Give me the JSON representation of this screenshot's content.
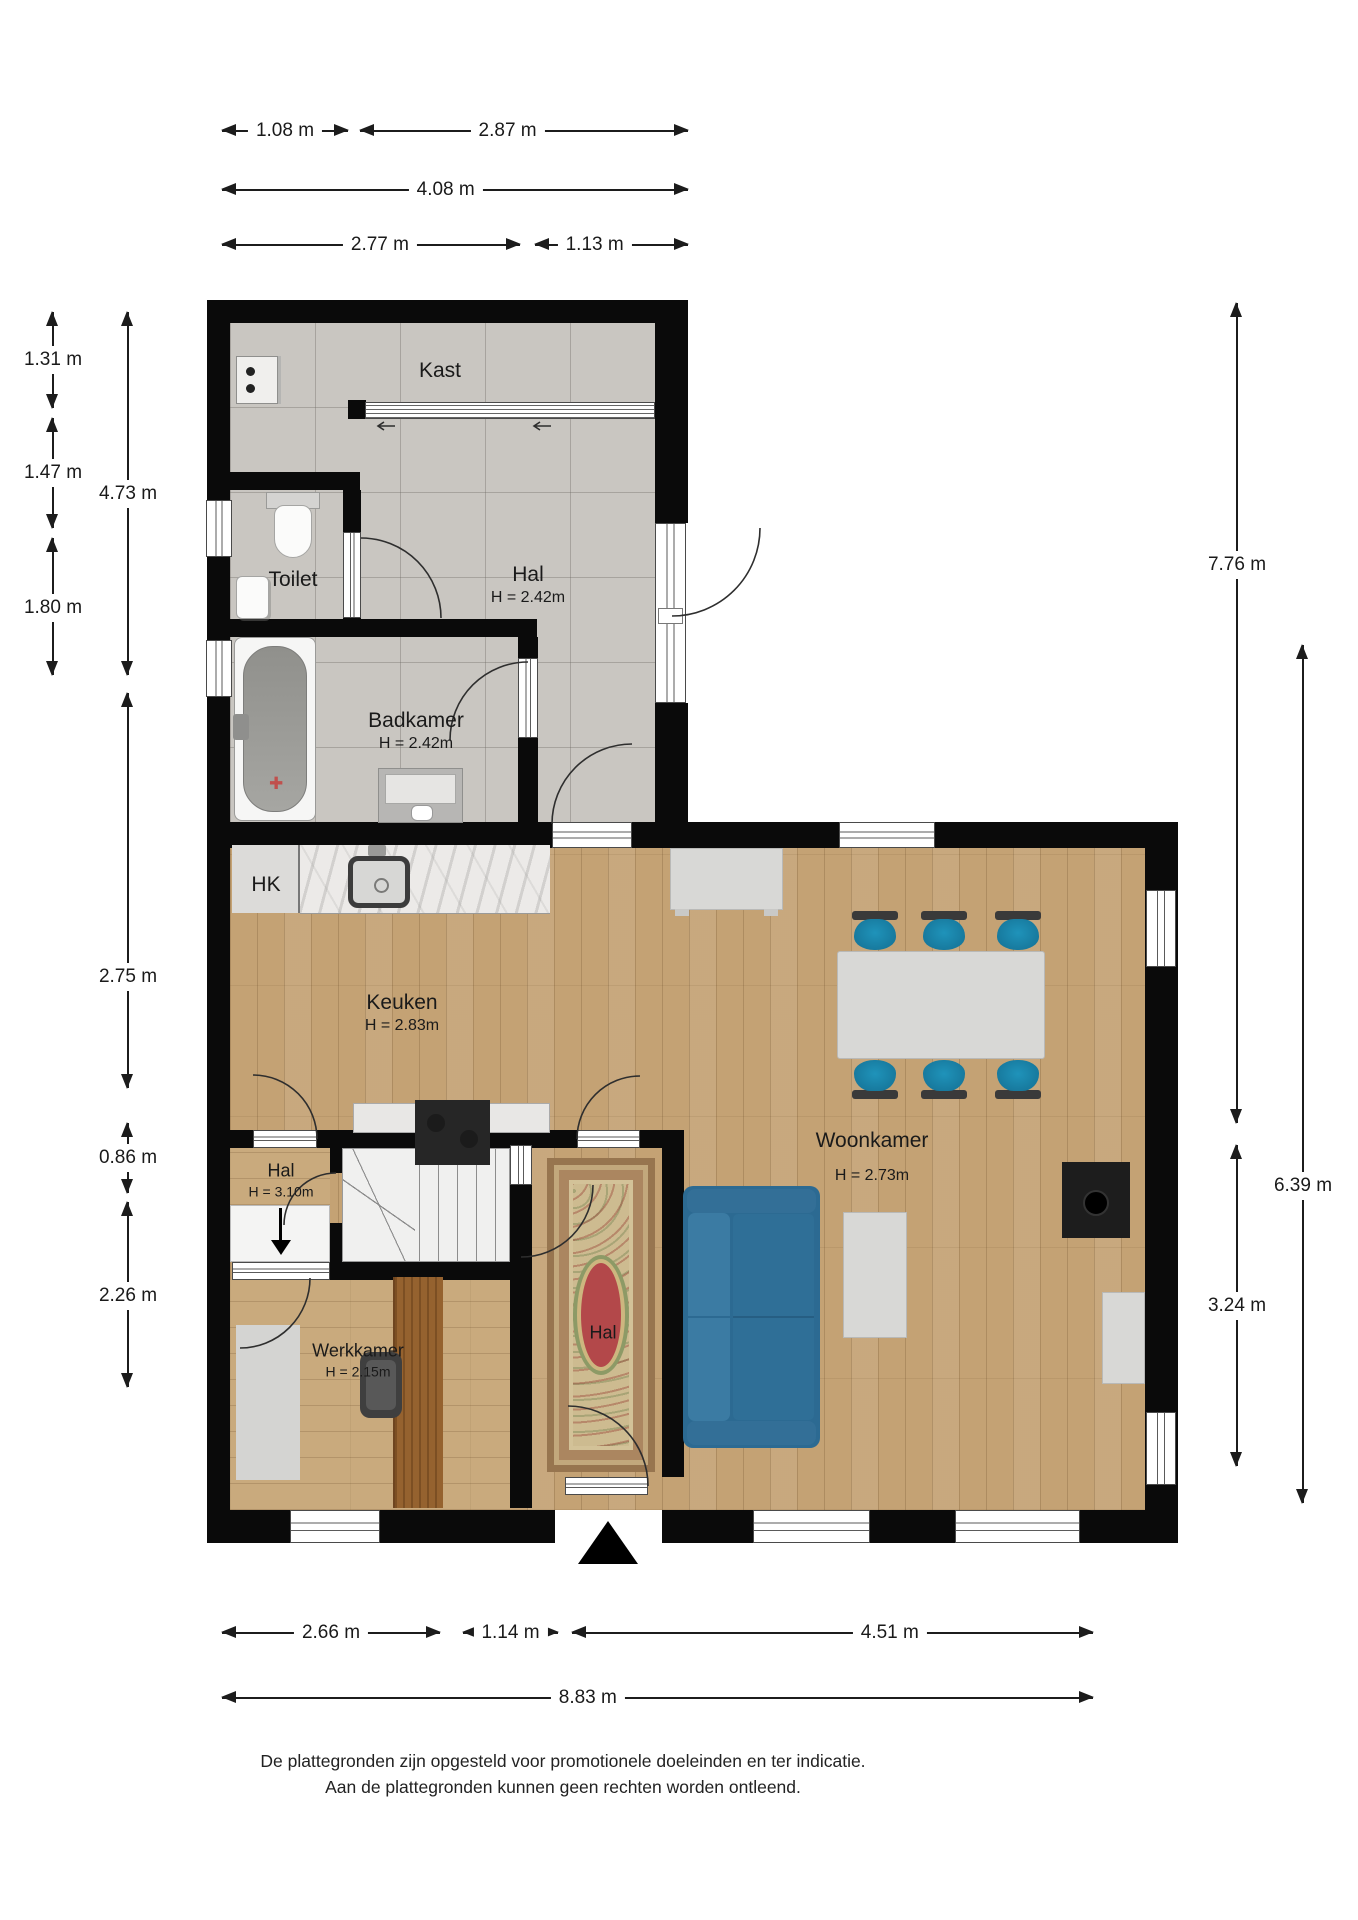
{
  "rooms": {
    "kast": {
      "label": "Kast"
    },
    "toilet": {
      "label": "Toilet"
    },
    "hal_upper": {
      "label": "Hal",
      "height": "H = 2.42m"
    },
    "badkamer": {
      "label": "Badkamer",
      "height": "H = 2.42m"
    },
    "hk": {
      "label": "HK"
    },
    "keuken": {
      "label": "Keuken",
      "height": "H = 2.83m"
    },
    "woonkamer": {
      "label": "Woonkamer",
      "height": "H = 2.73m"
    },
    "hal_inner": {
      "label": "Hal",
      "height": "H = 3.10m"
    },
    "werkkamer": {
      "label": "Werkkamer",
      "height": "H = 2.15m"
    },
    "hal_entree": {
      "label": "Hal"
    }
  },
  "dimensions": {
    "top": [
      "1.08 m",
      "2.87 m",
      "4.08 m",
      "2.77 m",
      "1.13 m"
    ],
    "left": [
      "1.31 m",
      "1.47 m",
      "1.80 m",
      "4.73 m",
      "2.75 m",
      "0.86 m",
      "2.26 m"
    ],
    "right": [
      "7.76 m",
      "6.39 m",
      "3.24 m"
    ],
    "bottom": [
      "2.66 m",
      "1.14 m",
      "4.51 m",
      "8.83 m"
    ]
  },
  "footer": {
    "line1": "De plattegronden zijn opgesteld voor promotionele doeleinden en ter indicatie.",
    "line2": "Aan de plattegronden kunnen geen rechten worden ontleend."
  },
  "colors": {
    "wall": "#0a0a0a",
    "tile_floor": "#c9c6c1",
    "wood_floor": "#c4a274",
    "stool_teal": "#1b7d9d",
    "sofa_blue": "#2c6a92",
    "furniture_gray": "#d8d8d6",
    "dimension_text": "#1c1c1c"
  }
}
